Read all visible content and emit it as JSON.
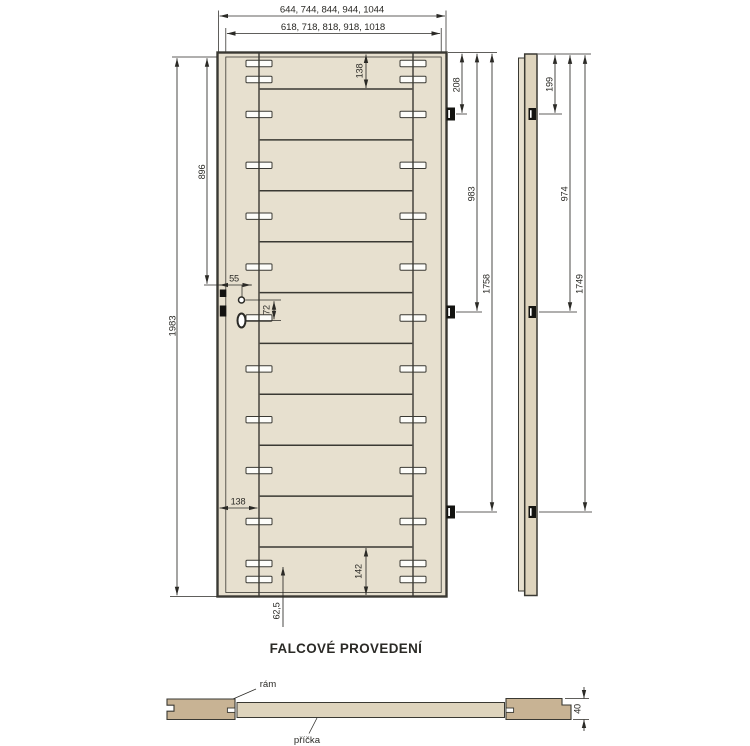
{
  "drawing": {
    "title": "FALCOVÉ PROVEDENÍ",
    "front_view": {
      "width_options_outer": "644, 744, 844, 944, 1044",
      "width_options_inner": "618, 718, 818, 918, 1018",
      "total_height": "1983",
      "handle_height_from_top": "896",
      "top_rail_height": "138",
      "stile_width": "138",
      "bottom_rail_height": "142",
      "bottom_dowel_offset": "62,5",
      "lock_backset": "55",
      "handle_to_cylinder": "72",
      "hinge_offsets_from_top": [
        "208",
        "983",
        "1758"
      ]
    },
    "side_view": {
      "hinge_offsets_from_top": [
        "199",
        "974",
        "1749"
      ]
    },
    "cross_section": {
      "frame_label": "rám",
      "rail_label": "příčka",
      "door_thickness": "40"
    },
    "colors": {
      "wood_light": "#e7e0cf",
      "wood_frame": "#c8b394",
      "wood_rail": "#ded4bd",
      "line": "#3a3933",
      "dimension": "#2b2a26",
      "background": "#ffffff"
    }
  }
}
